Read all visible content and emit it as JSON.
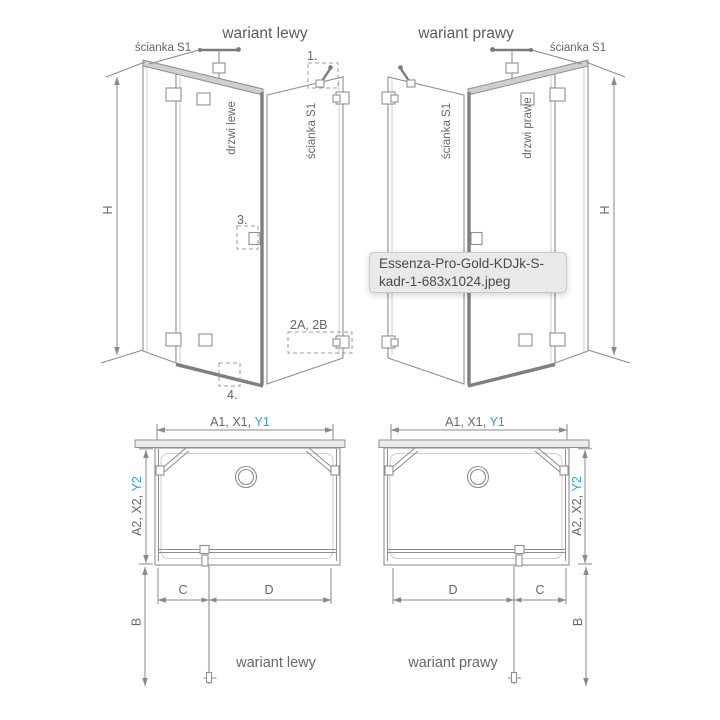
{
  "colors": {
    "accent": "#2b9fd9",
    "line": "#8e8e8e",
    "text": "#676767",
    "tooltip_bg": "#e9e8ea"
  },
  "tooltip": {
    "line1": "Essenza-Pro-Gold-KDJk-S-",
    "line2": "kadr-1-683x1024.jpeg"
  },
  "left_view": {
    "title": "wariant lewy",
    "wall_label": "ścianka S1",
    "door_label": "drzwi lewe",
    "side_wall_label": "ścianka S1",
    "height_label": "H",
    "callout_1": "1.",
    "callout_3": "3.",
    "callout_4": "4.",
    "callout_2ab": "2A, 2B"
  },
  "right_view": {
    "title": "wariant prawy",
    "wall_label": "ścianka S1",
    "door_label": "drzwi prawe",
    "side_wall_label": "ścianka S1",
    "height_label": "H"
  },
  "left_plan": {
    "width_dim_prefix": "A1, X1,",
    "width_dim_accent": "Y1",
    "depth_dim_prefix": "A2, X2,",
    "depth_dim_accent": "Y2",
    "b_label": "B",
    "c_label": "C",
    "d_label": "D",
    "caption": "wariant lewy"
  },
  "right_plan": {
    "width_dim_prefix": "A1, X1,",
    "width_dim_accent": "Y1",
    "depth_dim_prefix": "A2, X2,",
    "depth_dim_accent": "Y2",
    "b_label": "B",
    "c_label": "C",
    "d_label": "D",
    "caption": "wariant prawy"
  }
}
